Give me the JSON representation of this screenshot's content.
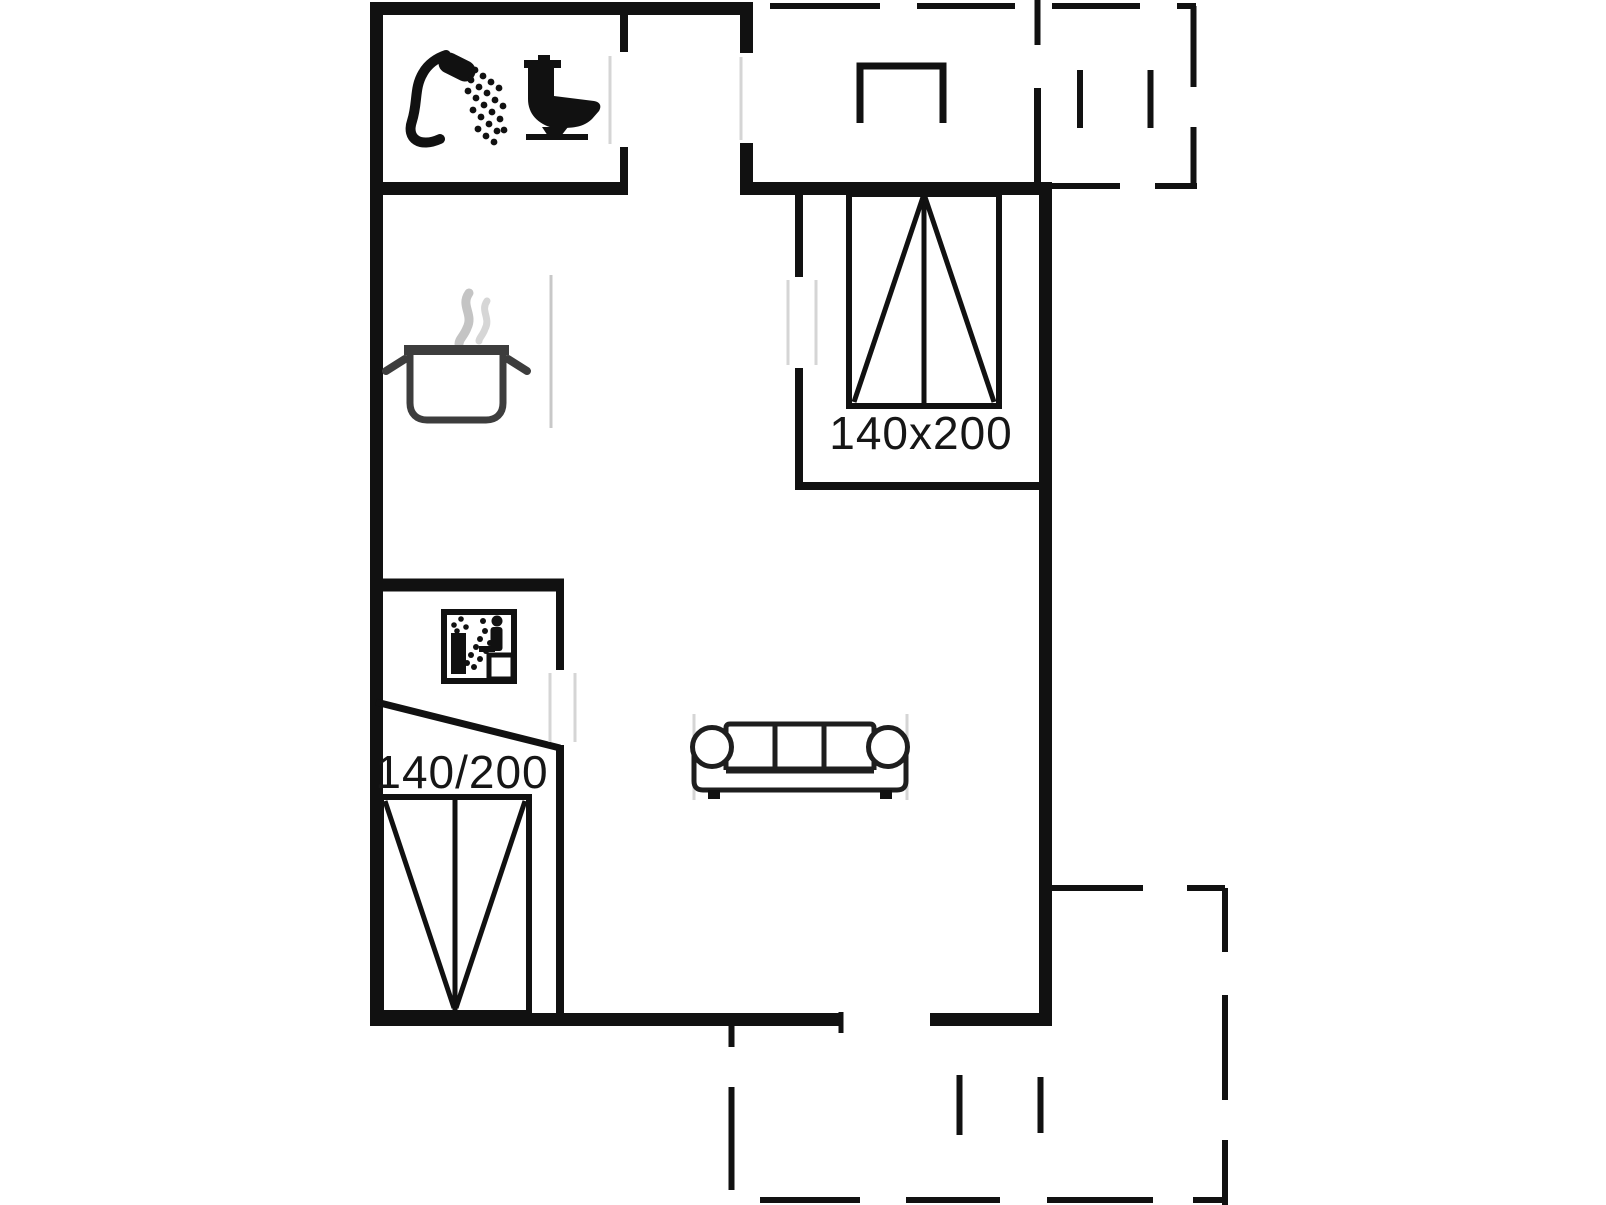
{
  "document": {
    "type": "holiday-home floor plan",
    "background_color": "#ffffff",
    "wall_color": "#111111",
    "dashed_line_meaning": "terrace / roofed outdoor area boundary"
  },
  "labels": {
    "bedroom_bed_size": "140x200",
    "alcove_bed_size": "140/200"
  },
  "rooms": [
    {
      "name": "bathroom",
      "icons": [
        "shower-icon",
        "toilet-icon"
      ]
    },
    {
      "name": "kitchen",
      "icons": [
        "cooking-pot-icon"
      ]
    },
    {
      "name": "sleeping-alcove",
      "icons": [
        "sauna-icon",
        "double-bed-icon"
      ],
      "bed_label": "140/200"
    },
    {
      "name": "bedroom",
      "icons": [
        "double-bed-icon"
      ],
      "bed_label": "140x200"
    },
    {
      "name": "living-room",
      "icons": [
        "sofa-icon"
      ]
    },
    {
      "name": "terrace-top-right",
      "icons": []
    },
    {
      "name": "porch",
      "icons": [
        "grill-or-step-icon"
      ]
    },
    {
      "name": "terrace-bottom",
      "icons": []
    }
  ],
  "colors": {
    "wall": "#111111",
    "icon_gray": "#3d3d3d",
    "steam_gray": "#c4c4c4",
    "faint_door": "#d5d5d5",
    "text": "#161616"
  }
}
